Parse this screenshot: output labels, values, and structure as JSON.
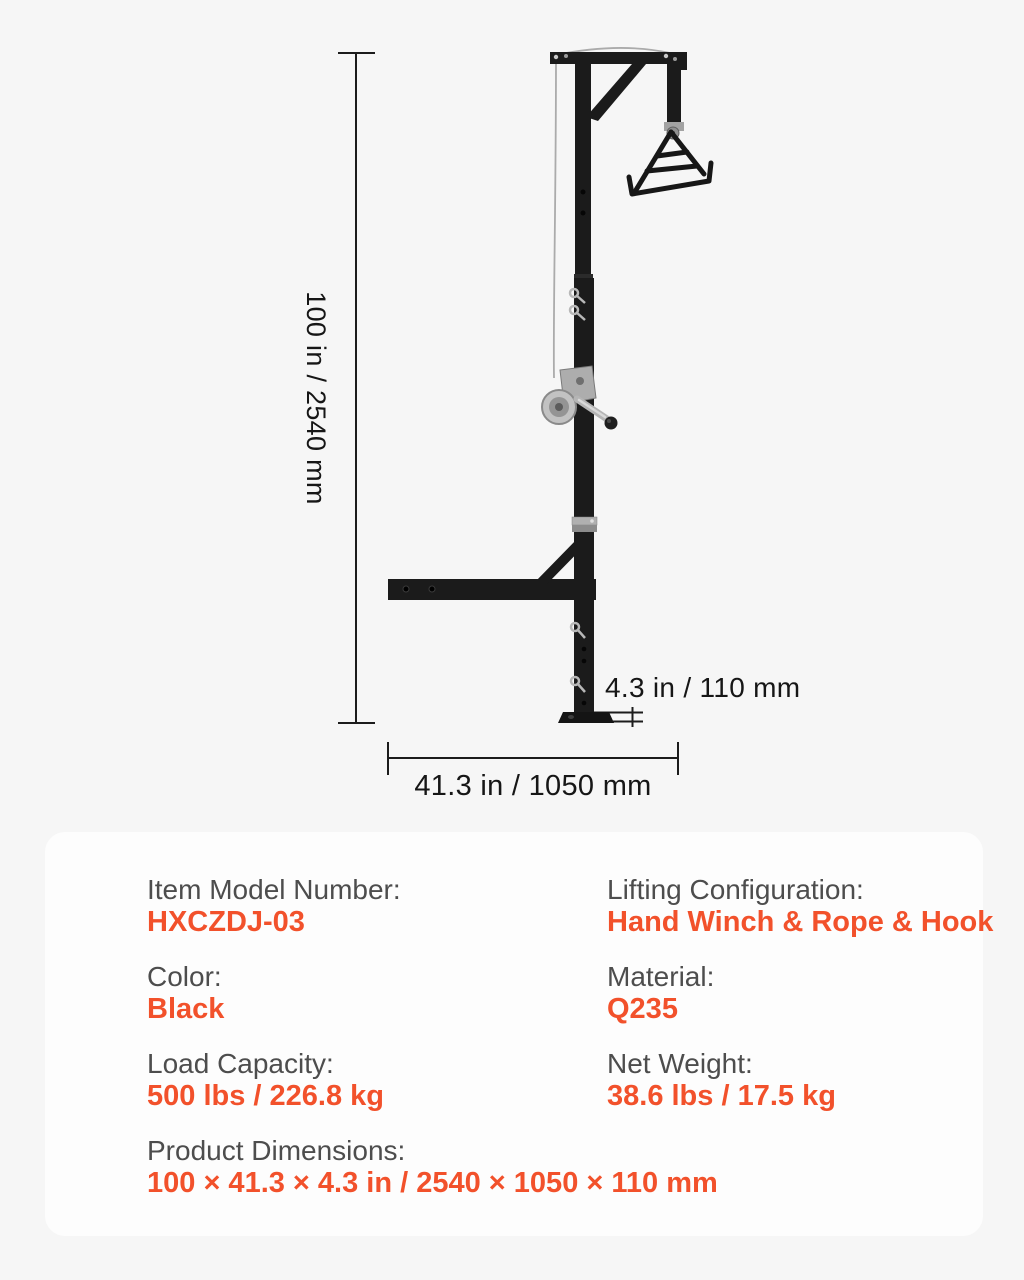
{
  "diagram": {
    "height_label": "100 in / 2540 mm",
    "width_label": "41.3 in / 1050 mm",
    "depth_label": "4.3 in / 110 mm"
  },
  "specs": {
    "items": [
      {
        "label": "Item Model Number:",
        "value": "HXCZDJ-03"
      },
      {
        "label": "Lifting Configuration:",
        "value": "Hand Winch & Rope & Hook"
      },
      {
        "label": "Color:",
        "value": "Black"
      },
      {
        "label": "Material:",
        "value": "Q235"
      },
      {
        "label": "Load Capacity:",
        "value": "500 lbs / 226.8 kg"
      },
      {
        "label": "Net Weight:",
        "value": "38.6 lbs / 17.5 kg"
      },
      {
        "label": "Product Dimensions:",
        "value": "100 × 41.3 × 4.3 in / 2540 × 1050 × 110 mm"
      }
    ]
  },
  "colors": {
    "accent_orange": "#f2512b",
    "label_gray": "#4d4d4d",
    "structure_black": "#1b1b1b",
    "dimension_line": "#1c1c1c",
    "panel_background": "#fdfdfd",
    "page_background": "#f6f6f6"
  }
}
